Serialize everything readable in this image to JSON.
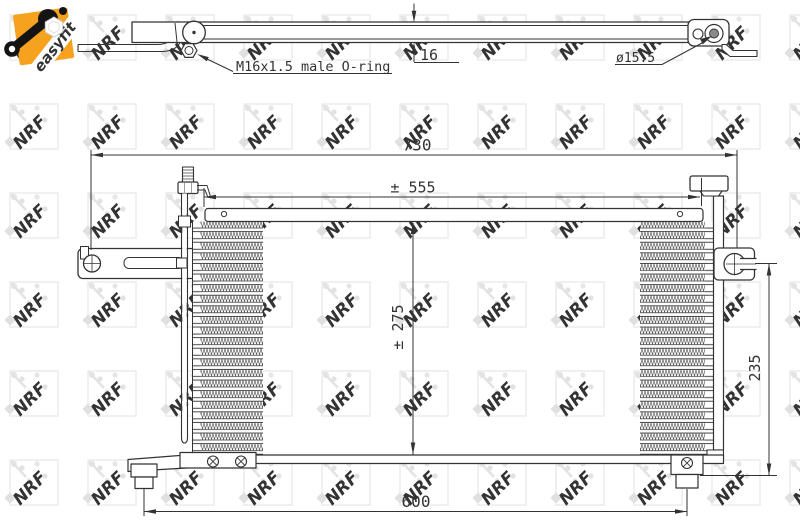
{
  "branding": {
    "easyfit_label": "easyfit",
    "watermark_text": "NRF",
    "colors": {
      "logo_orange": "#f6a21f",
      "logo_text": "#dd7e00",
      "wrench_black": "#141414",
      "watermark_gray": "#e9e9e9",
      "line_color": "#333333"
    }
  },
  "drawing": {
    "side_view": {
      "fitting_label": "M16x1.5 male O-ring",
      "port_diameter_label": "ø15.5",
      "thickness_label": "16"
    },
    "front_view": {
      "overall_width_label": "730",
      "core_width_label": "± 555",
      "core_height_label": "± 275",
      "right_height_label": "235",
      "mounting_width_label": "600"
    }
  }
}
